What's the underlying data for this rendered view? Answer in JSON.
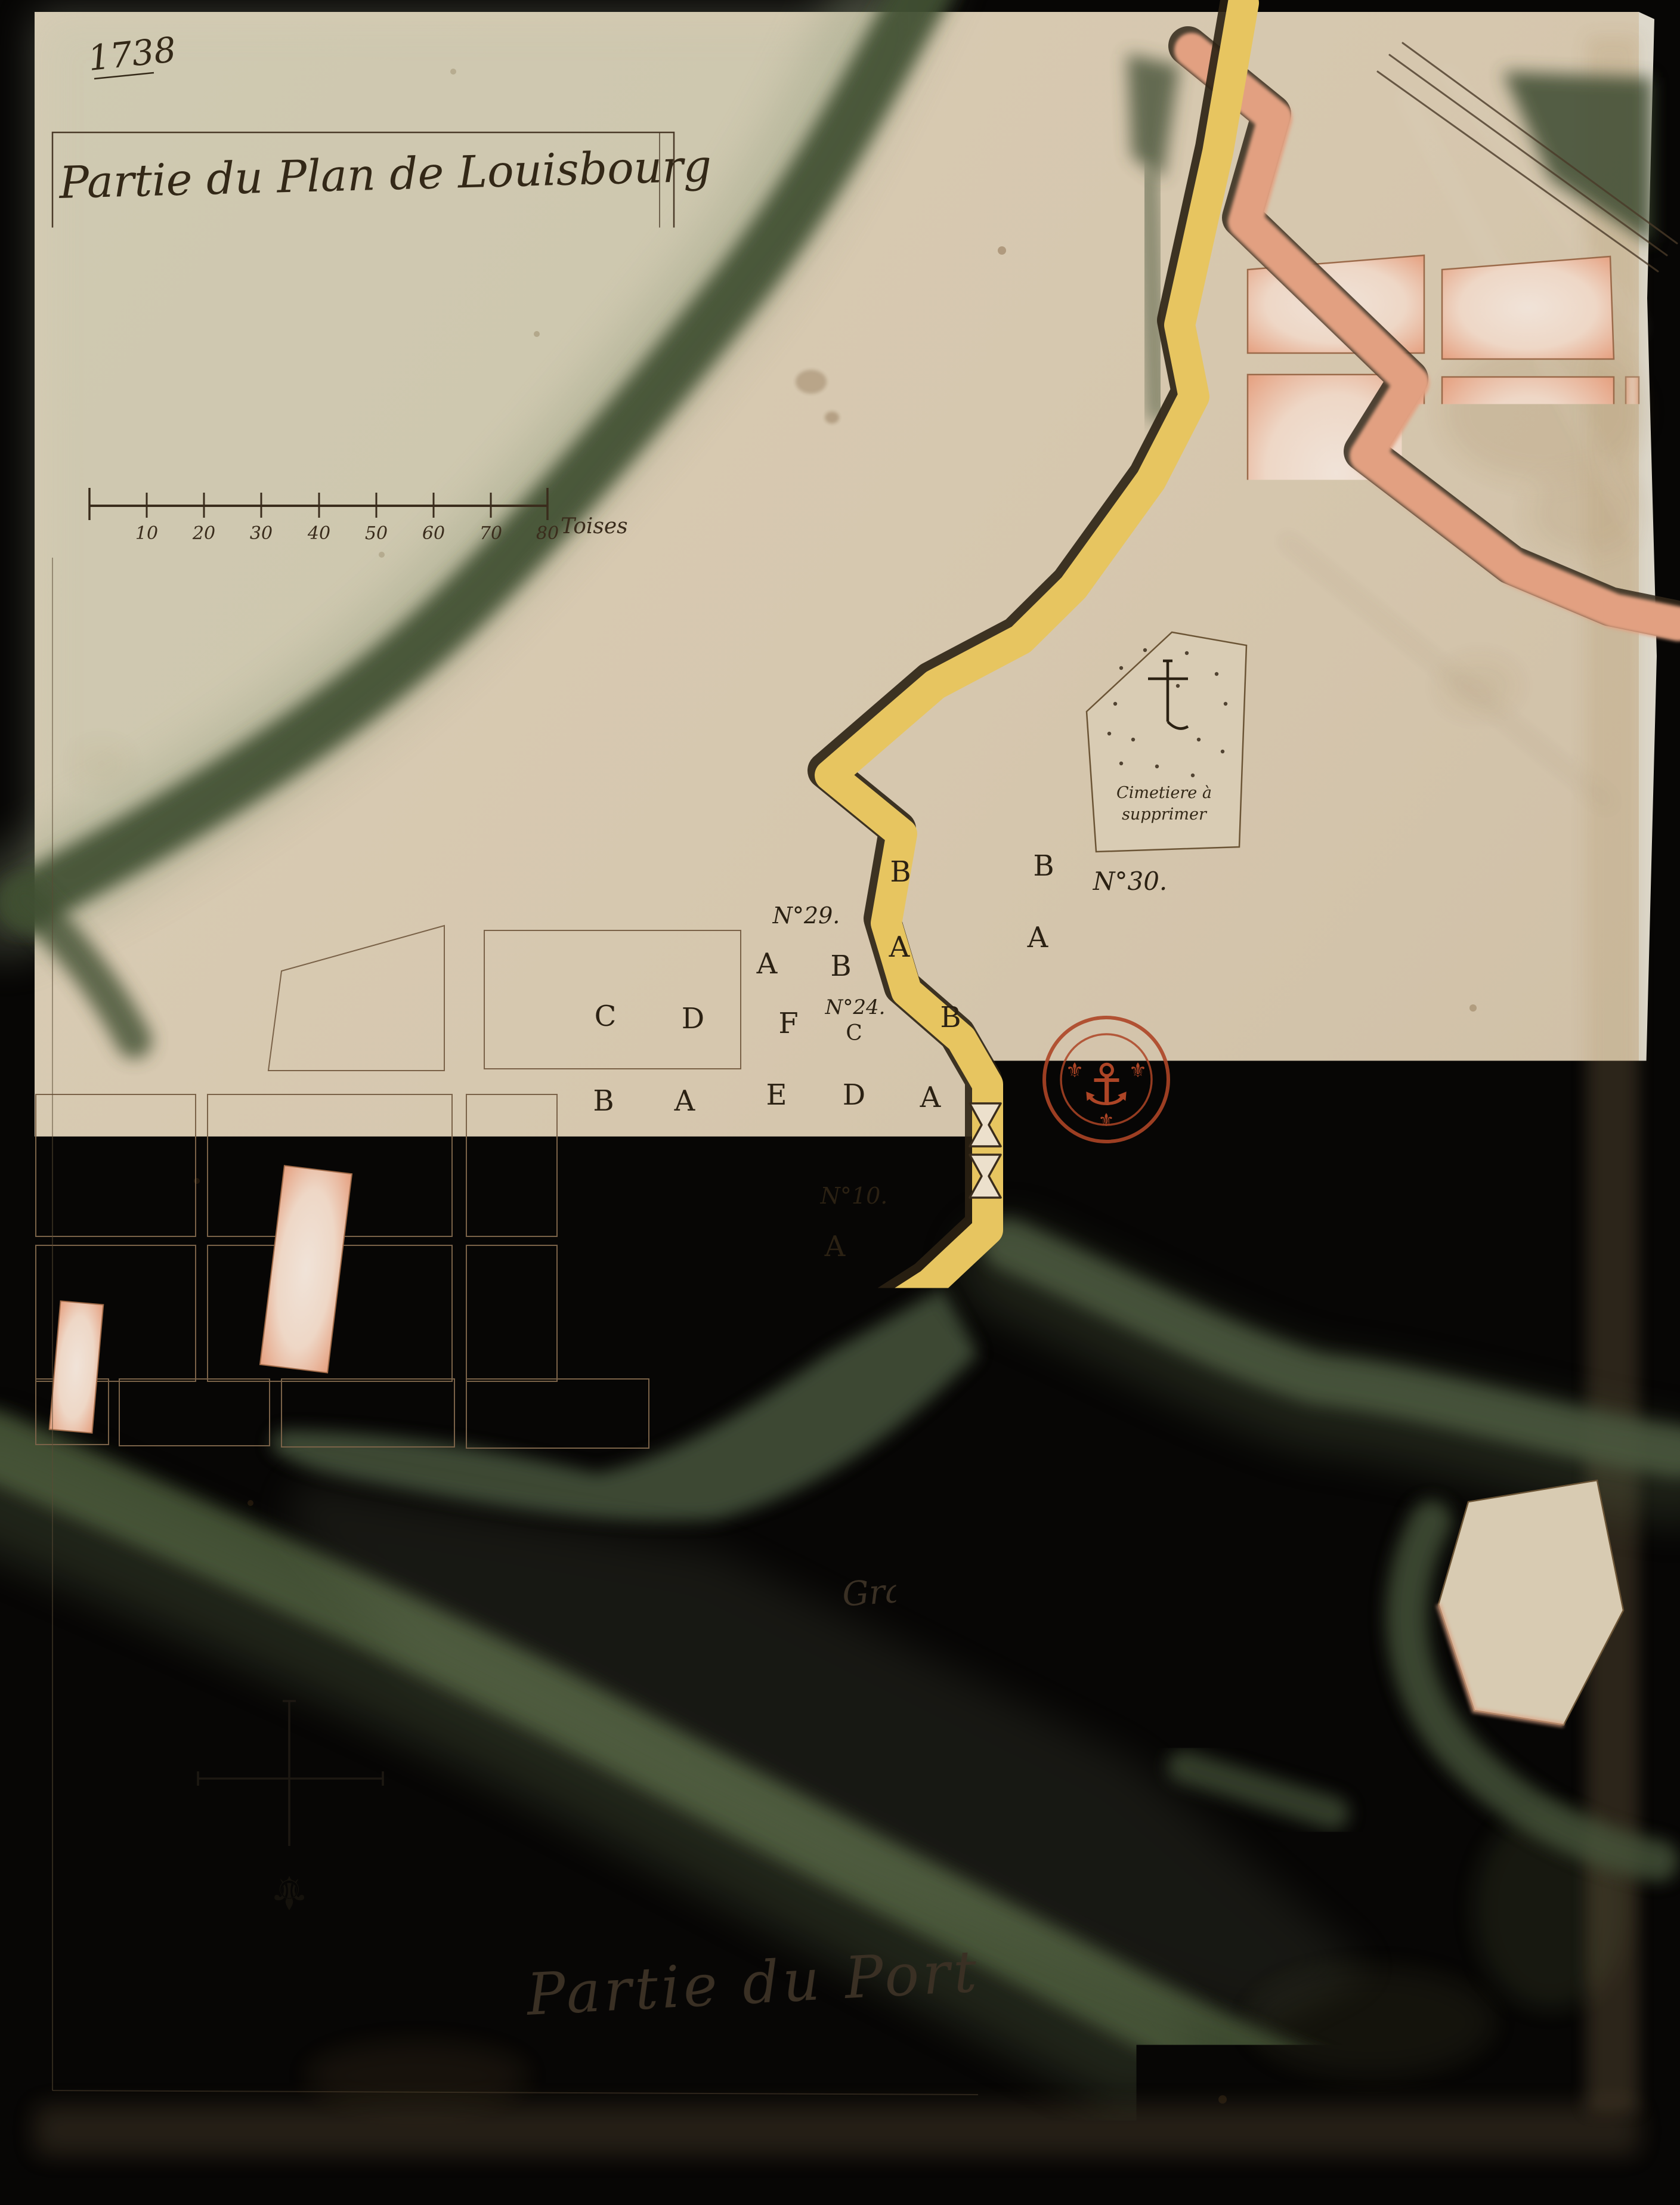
{
  "document": {
    "year_annotation": "1738",
    "title_line1": "Partie du Plan de Louisbourg",
    "title_line2": "ou sont representé les terrains qui seront",
    "title_line3": "occupé par la nouvelle fortification —",
    "title_line4": "Colorée de Jaune, 1738.",
    "order_number": "N°. d'ordre 192."
  },
  "scale_bar": {
    "ticks": [
      "10",
      "20",
      "30",
      "40",
      "50",
      "60",
      "70",
      "80"
    ],
    "unit": "Toises"
  },
  "geography": {
    "sea_label": "Mer du Large",
    "pond_label": "Grand Etang",
    "harbor_label": "Partie du Port"
  },
  "cemetery": {
    "line1": "Cimetiere à",
    "line2": "supprimer"
  },
  "stamp": {
    "text": "DEPOT DES COLONIES FRANÇAISES",
    "anchor_icon": "⚓",
    "fleur_icon": "⚜"
  },
  "compass": {
    "fleur_icon": "⚜"
  },
  "lots": {
    "no25": "N°25",
    "c1": "C",
    "d1": "D",
    "f1": "F",
    "no24": "N°24.",
    "c2": "C",
    "b4": "B",
    "b5": "B",
    "a4": "A",
    "e1": "E",
    "d2": "D",
    "a5": "A",
    "no29": "N°29.",
    "a1": "A",
    "b1": "B",
    "b2": "B",
    "a2": "A",
    "b3": "B",
    "a3": "A",
    "no30": "N°30.",
    "no10": "N°10.",
    "a6": "A",
    "g1": "G."
  },
  "colors": {
    "new_fortification_yellow": "#e7c560",
    "old_fortification_pink": "#e29f82",
    "shoreline_green": "#46543a",
    "town_block_pink": "#eba98a",
    "stamp_red": "#ad4526",
    "ink_brown": "#3a2c1c",
    "paper": "#d8c9b0"
  }
}
